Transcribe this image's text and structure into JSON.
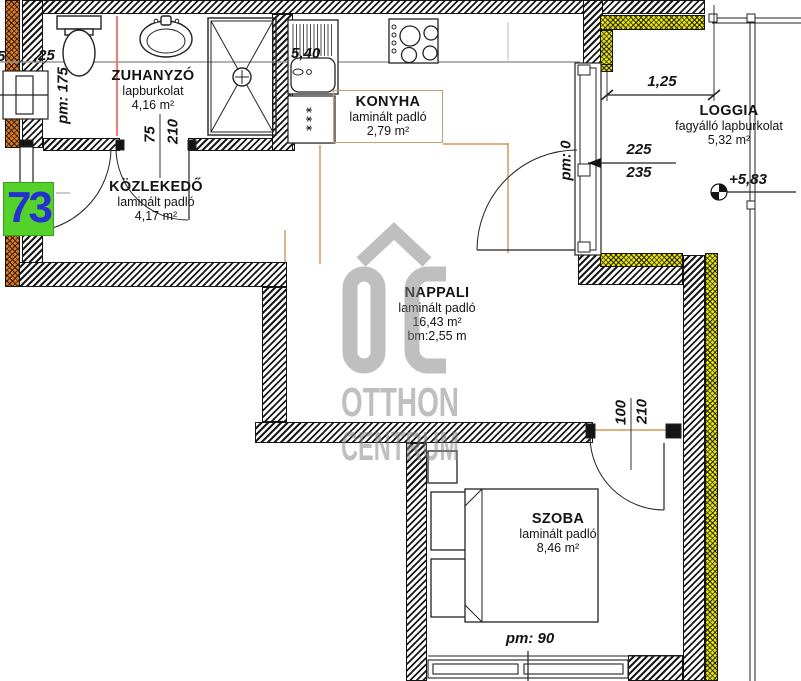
{
  "unit_badge": {
    "number": "73",
    "bg": "#54d22b",
    "fg": "#2531d1"
  },
  "rooms": [
    {
      "name": "ZUHANYZÓ",
      "floor": "lapburkolat",
      "area": "4,16 m²"
    },
    {
      "name": "KÖZLEKEDŐ",
      "floor": "laminált padló",
      "area": "4,17 m²"
    },
    {
      "name": "KONYHA",
      "floor": "laminált padló",
      "area": "2,79 m²"
    },
    {
      "name": "NAPPALI",
      "floor": "laminált padló",
      "area": "16,43 m²",
      "ceiling": "bm:2,55 m"
    },
    {
      "name": "LOGGIA",
      "floor": "fagyálló lapburkolat",
      "area": "5,32 m²"
    },
    {
      "name": "SZOBA",
      "floor": "laminált padló",
      "area": "8,46 m²"
    }
  ],
  "dimensions": {
    "left_partial": "5",
    "wall_top_left": ",25",
    "bath_sill": "pm: 175",
    "bath_door_width": "75",
    "bath_door_height": "210",
    "kitchen_run": "5,40",
    "balcony_sill": "pm: 0",
    "loggia_width": "1,25",
    "loggia_door_width": "225",
    "loggia_door_height": "235",
    "elevation": "+5,83",
    "szoba_door_width": "100",
    "szoba_door_height": "210",
    "szoba_sill": "pm: 90"
  },
  "watermark": {
    "logo": "OC",
    "line1": "OTTHON",
    "line2": "CENTRUM"
  },
  "colors": {
    "wall_hatch": "#1a1a1a",
    "insulation_yellow": "#e8e400",
    "insulation_orange": "#e2781e",
    "room_boundary": "#c87f3c",
    "section_line": "#999999",
    "shower_divider": "#e8807a",
    "watermark": "#808080"
  }
}
